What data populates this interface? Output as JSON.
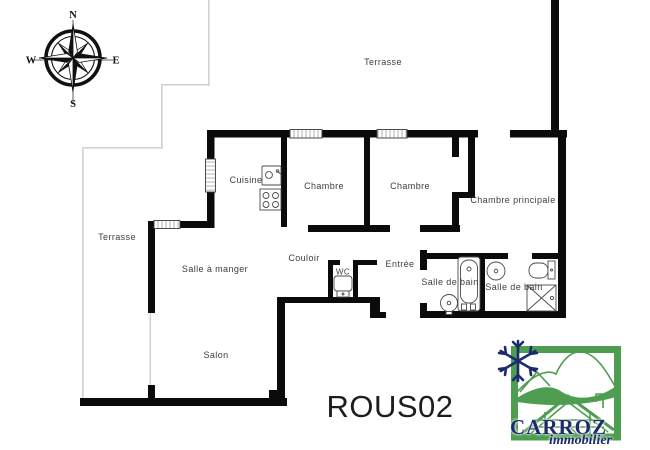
{
  "plan": {
    "reference": "ROUS02",
    "compass": {
      "north": "N",
      "east": "E",
      "south": "S",
      "west": "W"
    },
    "rooms": {
      "terrasse_top": "Terrasse",
      "cuisine": "Cuisine",
      "chambre_1": "Chambre",
      "chambre_2": "Chambre",
      "chambre_principale": "Chambre principale",
      "terrasse_left": "Terrasse",
      "salle_a_manger": "Salle à manger",
      "couloir": "Couloir",
      "wc": "WC",
      "entree": "Entrée",
      "salle_de_bain_1": "Salle de bain",
      "salle_de_bain_2": "Salle de bain",
      "salon": "Salon"
    }
  },
  "logo": {
    "brand": "CARROZ",
    "tagline": "immobilier"
  },
  "colors": {
    "wall": "#0b0b0b",
    "terrace_line": "#d2d2d2",
    "label": "#3d3d3d",
    "logo_green": "#4e9d50",
    "logo_navy": "#1e2a6e"
  }
}
